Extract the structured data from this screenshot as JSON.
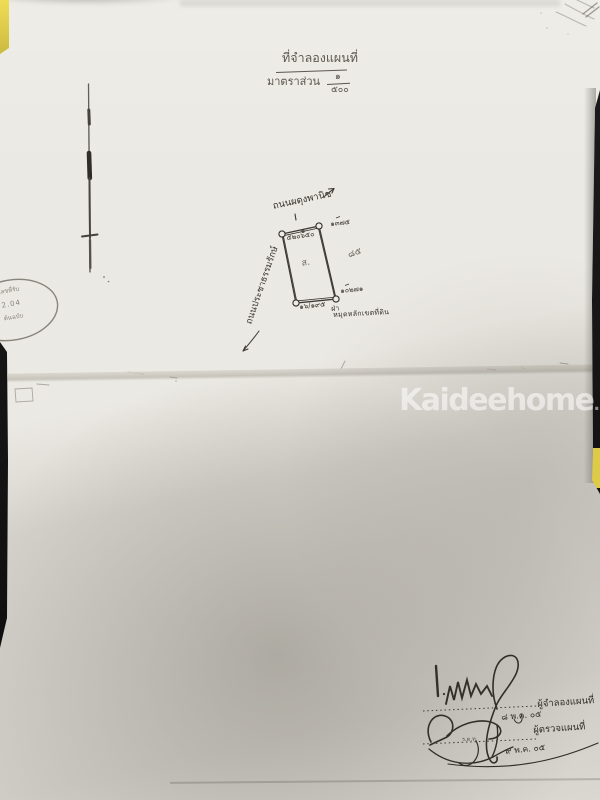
{
  "header": {
    "title": "ที่จำลองแผนที่",
    "scale_label": "มาตราส่วน",
    "scale_numerator": "๑",
    "scale_denominator": "๕๐๐"
  },
  "sketch": {
    "road_top": "ถนนผดุงพานิช",
    "road_left": "ถนนประชาธรรมรักษ์",
    "corner_top_left": "๕๒๐๖๕๐",
    "corner_top_right": "๑๓๗๕",
    "corner_bottom_right": "๑๐๒๗๑",
    "edge_bottom_label": "๑๖/๑๙๕",
    "note_prefix": "ฝ่า",
    "note": "หมุดหลักเขตที่ดิน",
    "pencil_mark_inside": "ส.",
    "pencil_mark_right": "๘๕"
  },
  "stamp": {
    "arc_top": "เลขที่รับ",
    "center": "2.04",
    "arc_bottom": "ต้นฉบับ"
  },
  "signature_block": {
    "surveyor_label": "ผู้จำลองแผนที่",
    "surveyor_date": "๘ พ.ค. ๐๕",
    "inspector_rank": "ร.ต.ท.",
    "inspector_label": "ผู้ตรวจแผนที่",
    "inspector_date": "๙ พ.ค. ๐๕"
  },
  "watermark": {
    "text": "Kaideehome",
    "suffix": ".com"
  },
  "colors": {
    "paper": "#ebe9e3",
    "background_dark": "#141414",
    "tape_yellow": "#e6d14e",
    "ink": "#36322b",
    "watermark_white": "#ffffff"
  }
}
